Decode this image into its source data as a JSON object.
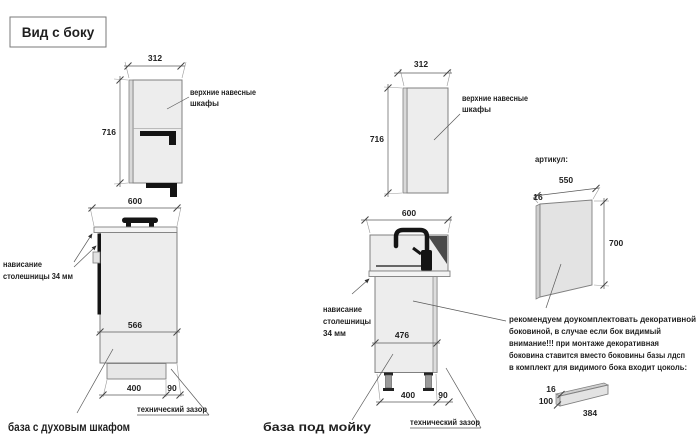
{
  "title": "Вид с боку",
  "colors": {
    "warning_red": "#c0392b",
    "drawing_fill": "#ededed",
    "black_detail": "#141414"
  },
  "upper_cabinet_left": {
    "width": "312",
    "height": "716",
    "label": [
      "верхние навесные",
      "шкафы"
    ]
  },
  "upper_cabinet_mid": {
    "width": "312",
    "height": "716",
    "label": [
      "верхние навесные",
      "шкафы"
    ]
  },
  "base_oven": {
    "width": "600",
    "inner_depth": "566",
    "plinth_depth": "400",
    "gap": "90",
    "overhang": [
      "нависание",
      "столешницы 34 мм"
    ],
    "gap_label": "технический зазор",
    "caption": "база с духовым шкафом"
  },
  "base_sink": {
    "width": "600",
    "inner_depth": "476",
    "plinth_depth": "400",
    "gap": "90",
    "overhang": [
      "нависание",
      "столешницы",
      "34 мм"
    ],
    "gap_label": "технический зазор",
    "caption": "база под мойку"
  },
  "side_panel": {
    "label": "артикул:",
    "width": "550",
    "thickness": "16",
    "height": "700"
  },
  "note": {
    "black1": "рекомендуем доукомплектовать декоративной",
    "black2": "боковиной, в случае если бок видимый",
    "red1": "внимание!!! при монтаже декоративная",
    "red2": "боковина ставится вместо боковины базы лдсп",
    "black3": "в комплект для видимого бока входит цоколь:"
  },
  "plinth_panel": {
    "thickness": "16",
    "height": "100",
    "length": "384"
  }
}
